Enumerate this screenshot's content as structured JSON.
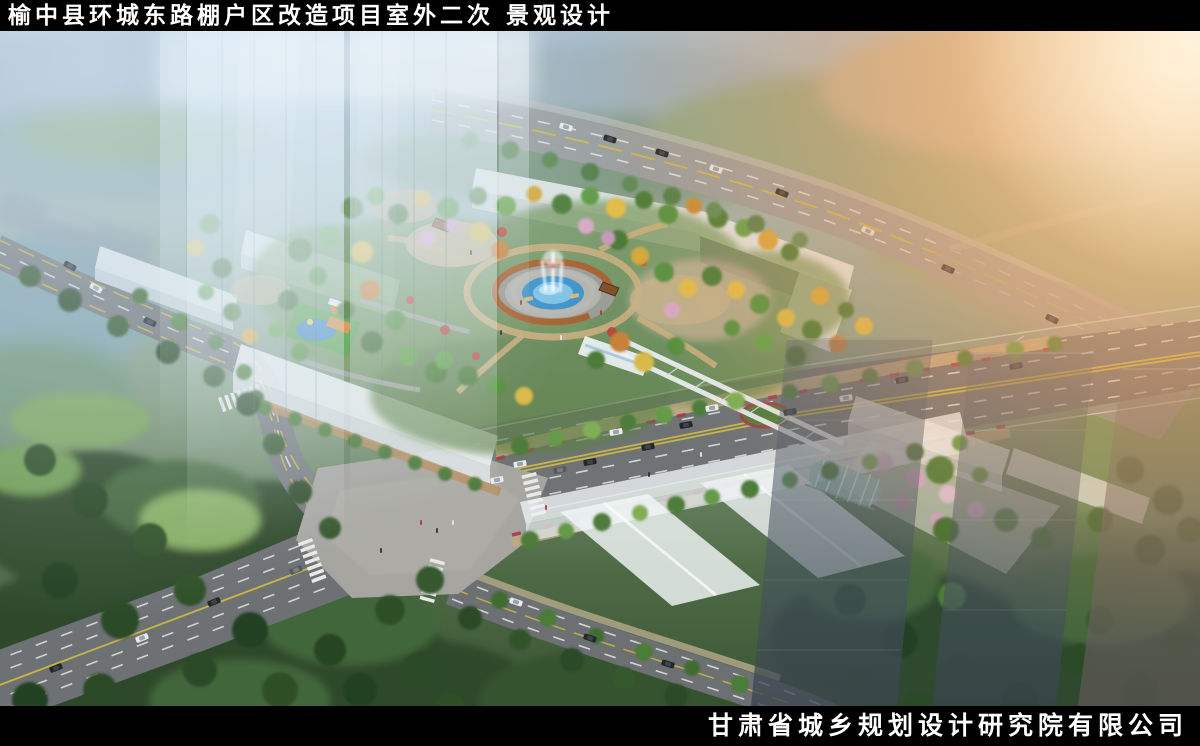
{
  "header": {
    "title": "榆中县环城东路棚户区改造项目室外二次 景观设计"
  },
  "footer": {
    "company": "甘肃省城乡规划设计研究院有限公司"
  },
  "palette": {
    "bar_background": "#000000",
    "title_color": "#ffffff",
    "sun_glow": "#f5a55e",
    "sky_haze": "#c8dcec",
    "road_asphalt": "#6f7275",
    "building_white": "#f2f5f7",
    "foliage_green": "#4e7c3a",
    "foliage_autumn": "#d9a33a",
    "water_blue": "#3e92cb",
    "pergola_rust": "#a8602c"
  }
}
